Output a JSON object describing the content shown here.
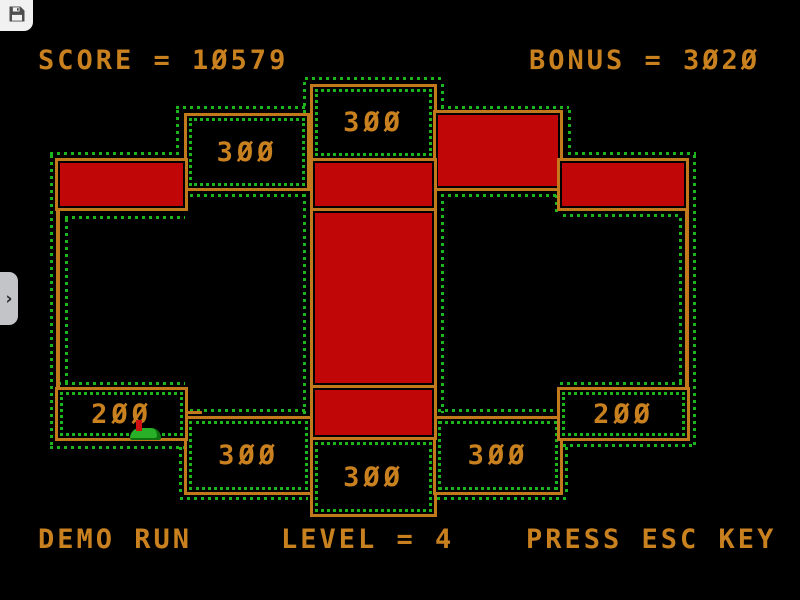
{
  "controls": {
    "save_button": {
      "icon": "floppy-disk-icon"
    },
    "sidebar_toggle": {
      "icon": "chevron-right-icon",
      "glyph": "›"
    }
  },
  "hud": {
    "score_display": "SCORE = 10579",
    "bonus_display": "BONUS = 3020",
    "demo_display": "DEMO RUN",
    "level_display": "LEVEL = 4",
    "esc_display": "PRESS ESC KEY",
    "score_value": 10579,
    "bonus_value": 3020,
    "level_value": 4
  },
  "board": {
    "boxes": {
      "top_center": {
        "label": "300"
      },
      "top_left": {
        "label": "300"
      },
      "bottom_left_200": {
        "label": "200"
      },
      "bottom_left_300": {
        "label": "300"
      },
      "bottom_center_300": {
        "label": "300"
      },
      "bottom_right_300": {
        "label": "300"
      },
      "bottom_right_200": {
        "label": "200"
      }
    },
    "red_block_count": 6,
    "sprite": "player-creature",
    "colors": {
      "outline": "#c1791b",
      "text": "#c9811f",
      "block_fill": "#c00606",
      "path_dots": "#1eb41e",
      "background": "#000000"
    }
  }
}
